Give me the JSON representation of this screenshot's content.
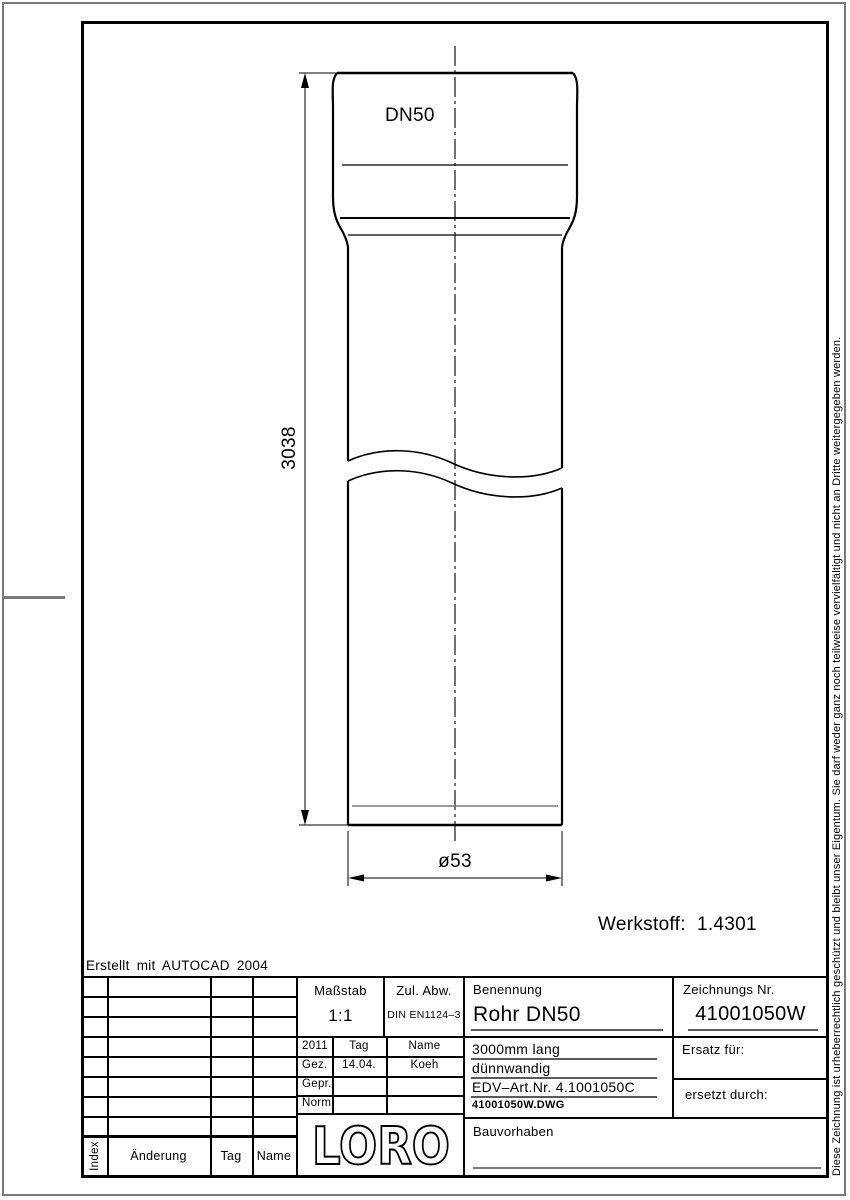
{
  "page": {
    "erstellt_note": "Erstellt mit AUTOCAD 2004",
    "copyright_vertical": "Diese Zeichnung ist urheberrechtlich geschützt und bleibt unser Eigentum. Sie darf weder ganz noch teilweise vervielfältigt und nicht an Dritte weitergegeben werden."
  },
  "drawing": {
    "nominal_size": "DN50",
    "length_dimension": "3038",
    "diameter_dimension": "ø53",
    "material_note": "Werkstoff:  1.4301"
  },
  "title_block": {
    "masstab": {
      "label": "Maßstab",
      "value": "1:1"
    },
    "zul_abw": {
      "label": "Zul. Abw.",
      "value": "DIN EN1124–3"
    },
    "approval": {
      "year": "2011",
      "tag_header": "Tag",
      "name_header": "Name",
      "rows": [
        {
          "label": "Gez.",
          "tag": "14.04.",
          "name": "Koeh"
        },
        {
          "label": "Gepr.",
          "tag": "",
          "name": ""
        },
        {
          "label": "Norm.",
          "tag": "",
          "name": ""
        }
      ]
    },
    "benennung": {
      "label": "Benennung",
      "value": "Rohr DN50"
    },
    "zeichnungs_nr": {
      "label": "Zeichnungs Nr.",
      "value": "41001050W"
    },
    "details": {
      "line1": "3000mm lang",
      "line2": "dünnwandig",
      "line3": "EDV–Art.Nr. 4.1001050C",
      "line4": "41001050W.DWG"
    },
    "ersatz_fuer": "Ersatz für:",
    "ersetzt_durch": "ersetzt durch:",
    "bauvorhaben": "Bauvorhaben",
    "logo_text": "LORO",
    "revision_headers": {
      "index": "Index",
      "aenderung": "Änderung",
      "tag": "Tag",
      "name": "Name"
    }
  },
  "colors": {
    "line": "#000000",
    "gray": "#7a7a7a",
    "form_line": "#5a5a5a"
  }
}
